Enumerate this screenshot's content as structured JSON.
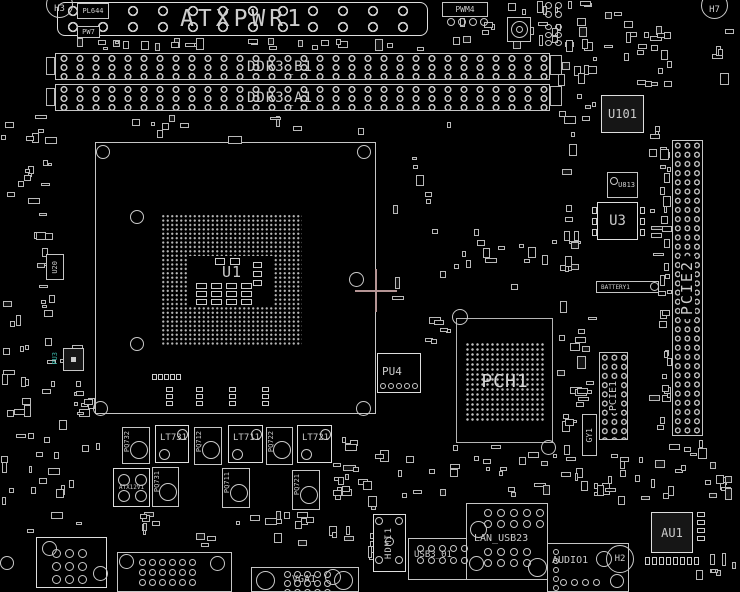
{
  "diagram": {
    "kind": "motherboard component placement drawing"
  },
  "colors": {
    "background": "#000000",
    "lines": "#c9c9c9",
    "crosshair": "#b59595",
    "teal_label": "#39b3a6"
  },
  "power": {
    "atx24": "ATXPWR1",
    "atx12v": "ATX12V1",
    "pwm": "PWM4",
    "pw7": "PW7",
    "pl644": "PL644"
  },
  "memory": {
    "slot_b": "DDR3_B1",
    "slot_a": "DDR3_A1"
  },
  "cpu": {
    "socket": "U1",
    "pu4": "PU4",
    "pu3": "PU3",
    "u20": "U20"
  },
  "chipset": {
    "pch": "PCH1",
    "battery": "BATTERY1",
    "u3": "U3",
    "u813": "U813",
    "u101": "U101",
    "gy1": "GY1"
  },
  "slots": {
    "pcie1": "PCIE1",
    "pcie2": "PCIE2"
  },
  "vrm": {
    "inductors": [
      "LT731",
      "LT711",
      "LT721"
    ],
    "mosfets_top": [
      "PQ732",
      "PQ712",
      "PQ722"
    ],
    "mosfets_bottom": [
      "PQ731",
      "PQ711",
      "PQ721"
    ]
  },
  "rear_io": {
    "hdmi": "HDMI1",
    "usb3": "USB3_01",
    "lan_usb": "LAN_USB23",
    "audio": "AUDIO1",
    "vga": "VGA1"
  },
  "audio_chip": "AU1",
  "crystals": {
    "h2": "H2",
    "h3": "H3",
    "h7": "H7"
  },
  "deco": {
    "scatter": [
      [
        60,
        38,
        368,
        13,
        26
      ],
      [
        435,
        17,
        165,
        36,
        20
      ],
      [
        490,
        0,
        108,
        16,
        8
      ],
      [
        600,
        0,
        72,
        92,
        14
      ],
      [
        645,
        25,
        28,
        68,
        8
      ],
      [
        0,
        112,
        58,
        95,
        18
      ],
      [
        33,
        205,
        28,
        130,
        14
      ],
      [
        0,
        300,
        36,
        125,
        14
      ],
      [
        38,
        335,
        58,
        85,
        16
      ],
      [
        556,
        55,
        42,
        140,
        16
      ],
      [
        556,
        200,
        40,
        78,
        10
      ],
      [
        556,
        300,
        42,
        142,
        20
      ],
      [
        648,
        100,
        22,
        330,
        18
      ],
      [
        380,
        120,
        85,
        95,
        7
      ],
      [
        390,
        228,
        172,
        82,
        18
      ],
      [
        425,
        315,
        28,
        35,
        6
      ],
      [
        330,
        415,
        45,
        88,
        12
      ],
      [
        0,
        418,
        110,
        115,
        22
      ],
      [
        120,
        508,
        238,
        40,
        26
      ],
      [
        330,
        445,
        130,
        58,
        16
      ],
      [
        465,
        442,
        95,
        55,
        14
      ],
      [
        560,
        440,
        85,
        58,
        12
      ],
      [
        633,
        440,
        100,
        64,
        14
      ],
      [
        695,
        552,
        42,
        36,
        7
      ],
      [
        700,
        462,
        38,
        48,
        8
      ],
      [
        660,
        145,
        12,
        288,
        22
      ],
      [
        95,
        115,
        280,
        24,
        10
      ],
      [
        700,
        15,
        38,
        78,
        5
      ],
      [
        368,
        495,
        12,
        75,
        7
      ],
      [
        600,
        452,
        30,
        53,
        6
      ]
    ],
    "grids": [
      [
        447,
        18,
        4,
        1,
        8,
        8,
        3,
        0,
        1
      ],
      [
        545,
        2,
        2,
        2,
        7,
        7,
        3,
        2,
        1
      ],
      [
        545,
        24,
        2,
        3,
        7,
        6,
        3,
        2,
        1
      ],
      [
        196,
        283,
        4,
        3,
        11,
        6,
        4,
        2,
        0
      ],
      [
        215,
        258,
        2,
        1,
        10,
        7,
        5,
        0,
        0
      ],
      [
        253,
        262,
        1,
        3,
        9,
        6,
        0,
        3,
        0
      ],
      [
        152,
        374,
        5,
        1,
        5,
        6,
        1,
        0,
        0
      ],
      [
        166,
        387,
        1,
        3,
        7,
        5,
        0,
        2,
        0
      ],
      [
        196,
        387,
        1,
        3,
        7,
        5,
        0,
        2,
        0
      ],
      [
        229,
        387,
        1,
        3,
        7,
        5,
        0,
        2,
        0
      ],
      [
        262,
        387,
        1,
        3,
        7,
        5,
        0,
        2,
        0
      ],
      [
        118,
        474,
        2,
        2,
        12,
        12,
        5,
        4,
        1
      ],
      [
        52,
        549,
        3,
        3,
        9,
        9,
        4,
        4,
        1
      ],
      [
        139,
        559,
        6,
        3,
        7,
        7,
        3,
        3,
        1
      ],
      [
        284,
        571,
        5,
        3,
        7,
        7,
        3,
        2,
        1
      ],
      [
        417,
        545,
        5,
        2,
        7,
        7,
        4,
        5,
        1
      ],
      [
        484,
        509,
        5,
        2,
        8,
        8,
        5,
        3,
        1
      ],
      [
        484,
        548,
        4,
        2,
        8,
        8,
        5,
        3,
        1
      ],
      [
        553,
        549,
        1,
        5,
        6,
        6,
        0,
        3,
        1
      ],
      [
        560,
        579,
        4,
        1,
        7,
        7,
        4,
        0,
        1
      ],
      [
        645,
        557,
        8,
        1,
        5,
        8,
        2,
        0,
        0
      ],
      [
        592,
        207,
        1,
        3,
        5,
        7,
        0,
        4,
        0
      ],
      [
        640,
        207,
        1,
        3,
        5,
        7,
        0,
        4,
        0
      ],
      [
        380,
        383,
        5,
        1,
        6,
        6,
        2,
        0,
        1
      ],
      [
        697,
        512,
        1,
        4,
        8,
        5,
        0,
        3,
        0
      ]
    ],
    "rings": [
      [
        96,
        145,
        14
      ],
      [
        357,
        145,
        14
      ],
      [
        130,
        210,
        14
      ],
      [
        349,
        272,
        15
      ],
      [
        130,
        337,
        14
      ],
      [
        93,
        401,
        15
      ],
      [
        356,
        401,
        15
      ],
      [
        452,
        309,
        16
      ],
      [
        541,
        440,
        15
      ],
      [
        119,
        554,
        15
      ],
      [
        210,
        556,
        15
      ],
      [
        256,
        571,
        19
      ],
      [
        334,
        571,
        19
      ],
      [
        42,
        541,
        15
      ],
      [
        93,
        566,
        15
      ],
      [
        470,
        521,
        17
      ],
      [
        528,
        558,
        19
      ],
      [
        469,
        556,
        15
      ],
      [
        596,
        551,
        16
      ],
      [
        610,
        574,
        14
      ],
      [
        375,
        517,
        8
      ],
      [
        395,
        517,
        8
      ],
      [
        375,
        556,
        8
      ],
      [
        385,
        537,
        9
      ],
      [
        395,
        556,
        8
      ],
      [
        0,
        556,
        14
      ],
      [
        325,
        569,
        16
      ],
      [
        650,
        282,
        9
      ],
      [
        610,
        177,
        8
      ],
      [
        511,
        21,
        17
      ],
      [
        516,
        26,
        7
      ]
    ]
  }
}
